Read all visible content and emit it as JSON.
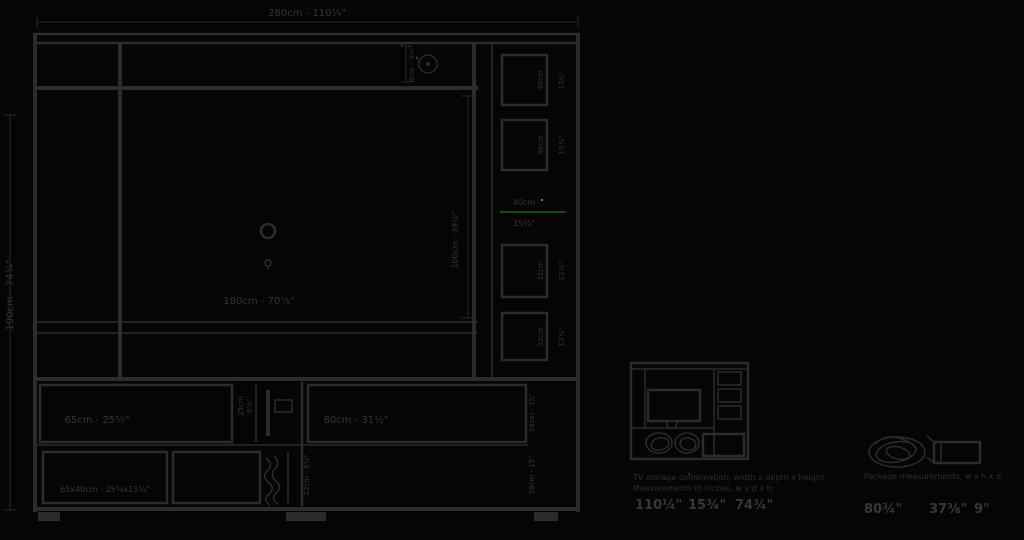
{
  "colors": {
    "background": "#050505",
    "stroke": "#2b2b30",
    "dimension_stroke": "#26262b",
    "text": "#35353c",
    "accent_green": "#0c4d12",
    "accent_green_bright": "#2e9a33"
  },
  "drawing": {
    "top_width": "280cm - 110¼\"",
    "left_height": "190cm - 74¾\"",
    "opening_width": "180cm - 70⅞\"",
    "opening_height": "100cm - 39⅜\"",
    "top_right_detail": "8cm - 3⅛\"",
    "gap_cm": "40cm",
    "gap_in": "15¾\"",
    "cubbies": [
      {
        "cm": "40cm",
        "in": "15¾\""
      },
      {
        "cm": "40cm",
        "in": "15¾\""
      },
      {
        "cm": "32cm",
        "in": "12⅝\""
      },
      {
        "cm": "32cm",
        "in": "12⅝\""
      }
    ],
    "base": {
      "left_row1": "65cm - 25⅝\"",
      "mid_cm": "25cm",
      "mid_in": "9⅞\"",
      "right_row1": "80cm - 31½\"",
      "right_dim_row1": "38cm - 15\"",
      "left_row2": "65x40cm - 25⅝x15¾\"",
      "mid_row2": "22cm - 8⅝\"",
      "right_dim_row2": "38cm - 15\""
    }
  },
  "thumbnails": {
    "combination": {
      "caption_line1": "TV storage combination, width x depth x height",
      "caption_line2": "Measurements in inches, w x d x h:",
      "bold": [
        "110¼\"",
        "15¾\"",
        "74¾\""
      ]
    },
    "package": {
      "caption_line1": "Package measurements, w x h x d:",
      "bold": [
        "80¾\"",
        "37⅜\"",
        "9\""
      ]
    }
  }
}
